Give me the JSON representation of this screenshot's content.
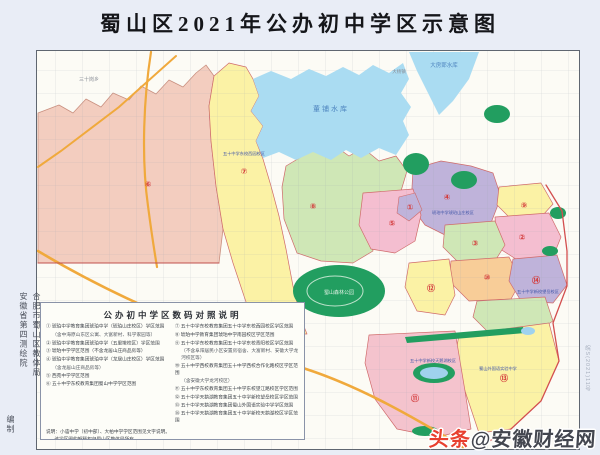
{
  "page": {
    "title": "蜀山区2021年公办初中学区示意图"
  },
  "credits": {
    "col1": "合肥市蜀山区教体局",
    "col2": "安徽省第四测绘院",
    "col3": "编制"
  },
  "map": {
    "labels": {
      "dongpu": "董铺水库",
      "dafangying": "大房郢水库",
      "forest": "蜀山森林公园",
      "town_nw": "三十岗乡",
      "town_n": "大杨镇",
      "school1": "五十中学东校西园校区",
      "school2": "琥珀中学琥珀山庄校区",
      "school3": "五十中学新校天鹅湖校区",
      "school4": "五十中学新校望岳校区",
      "school5": "蜀山外国语实验中学"
    },
    "nums": [
      "①",
      "②",
      "③",
      "④",
      "⑤",
      "⑥",
      "⑦",
      "⑧",
      "⑨",
      "⑩",
      "⑪",
      "⑫",
      "⑬",
      "⑭"
    ],
    "approval": "皖S(2021)11号"
  },
  "legend": {
    "title": "公办初中学区数码对照说明",
    "left": [
      "① 琥珀中学教育集团琥珀中学（琥珀山庄校区）学区范围",
      "（含中海原山东区公寓、大富新村、科学家园等）",
      "② 琥珀中学教育集团琥珀中学（五里墩校区）学区范围",
      "③ 琥珀中学学区范围（不含龙居山庄商品房等）",
      "④ 琥珀中学教育集团琥珀中学（龙居山庄校区）学区范围",
      "（含龙居山庄商品房等）",
      "⑤ 西苑中学学区范围",
      "⑥ 五十中学东校教育集团蜀山中学学区范围"
    ],
    "right": [
      "⑦ 五十中学东校教育集团五十中学东校西园校区学区范围",
      "⑧ 琥珀中学教育集团琥珀中学南园校区学区范围",
      "⑨ 五十中学东校教育集团五十中学东校青阳校区学区范围",
      "（不含阜阳居民小区安置房宿舍、大富新村、安徽大学龙河校区等）",
      "⑩ 五十中学西校教育集团五十中学西校合作化路校区学区范围",
      "（含安徽大学龙河校区）",
      "⑪ 五十中学东校教育集团五十中学东校望江路校区学区范围",
      "⑫ 五十中学天鹅湖教育集团五十中学新校望岳校区学区范围",
      "⑬ 五十中学天鹅湖教育集团蜀山外国语实验中学学区范围",
      "⑭ 五十中学天鹅湖教育集团五十中学新校天鹅湖校区学区范围"
    ],
    "notes": [
      "说明：小庙中学（初中部）、大柏中学学区范围见文字说明。",
      "该学区图的解释权归蜀山区教体局所有。"
    ]
  },
  "watermark": {
    "prefix": "头条",
    "handle": "@安徽财经网"
  },
  "colors": {
    "page_bg": "#e9edf6",
    "map_bg": "#fcfbf5",
    "district_salmon": "#f3cdbf",
    "district_yellow": "#fbf2a5",
    "district_green": "#cfe7b6",
    "district_purple": "#bfb3da",
    "district_rose": "#f4bed0",
    "district_orange": "#f8cd98",
    "water": "#aadcf2",
    "park": "#229e60",
    "road": "#f0a93c",
    "boundary": "#d34f4f"
  }
}
